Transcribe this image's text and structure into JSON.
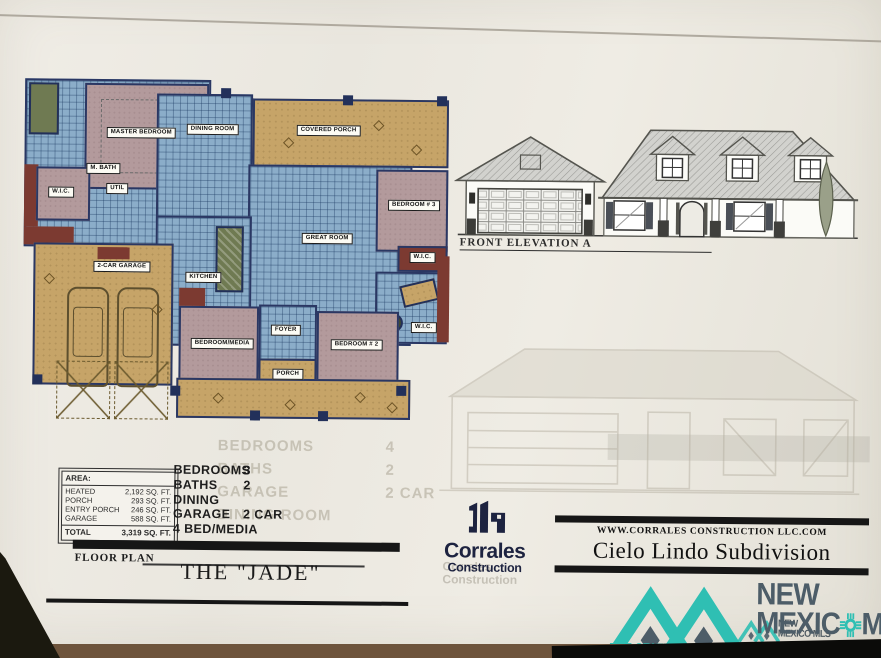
{
  "page": {
    "floor_plan_label": "FLOOR PLAN",
    "plan_name": "THE \"JADE\"",
    "elevation_label": "FRONT ELEVATION A"
  },
  "area_table": {
    "header": "AREA:",
    "rows": [
      {
        "label": "HEATED",
        "value": "2,192 SQ. FT."
      },
      {
        "label": "PORCH",
        "value": "293 SQ. FT."
      },
      {
        "label": "ENTRY PORCH",
        "value": "246 SQ. FT."
      },
      {
        "label": "GARAGE",
        "value": "588 SQ. FT."
      }
    ],
    "total": {
      "label": "TOTAL",
      "value": "3,319 SQ. FT."
    }
  },
  "specs": {
    "rows": [
      {
        "label": "BEDROOMS",
        "value": "3"
      },
      {
        "label": "BATHS",
        "value": "2"
      },
      {
        "label": "DINING",
        "value": ""
      },
      {
        "label": "GARAGE",
        "value": "2 CAR"
      },
      {
        "label": "4 BED/MEDIA",
        "value": ""
      }
    ]
  },
  "ghost_specs": {
    "rows": [
      {
        "label": "BEDROOMS",
        "value": "4"
      },
      {
        "label": "BATHS",
        "value": "2"
      },
      {
        "label": "GARAGE",
        "value": "2 CAR"
      },
      {
        "label": "DINING ROOM",
        "value": ""
      }
    ]
  },
  "builder": {
    "name_top": "Corrales",
    "name_bottom": "Construction",
    "website": "WWW.CORRALES CONSTRUCTION LLC.COM",
    "subdivision": "Cielo Lindo Subdivision"
  },
  "mls": {
    "word1": "NEW",
    "word2_left": "MEXIC",
    "word2_right": "MLS",
    "tagline": "THE STATEWIDE NETWORK OF NEW MEXICO",
    "ghost_line1": "NEW",
    "ghost_line2": "MEXICO MLS",
    "teal": "#2fbfb3",
    "slate": "#4d5d68"
  },
  "rooms": {
    "master": "MASTER BEDROOM",
    "mbath": "M. BATH",
    "wic1": "W.I.C.",
    "util": "UTIL",
    "dining": "DINING ROOM",
    "covered_porch": "COVERED PORCH",
    "great": "GREAT ROOM",
    "bed3": "BEDROOM # 3",
    "wic3": "W.I.C.",
    "wic2": "W.I.C.",
    "kitchen": "KITCHEN",
    "garage": "2-CAR GARAGE",
    "bedmedia": "BEDROOM/MEDIA",
    "foyer": "FOYER",
    "bed2": "BEDROOM # 2",
    "porch": "PORCH"
  }
}
